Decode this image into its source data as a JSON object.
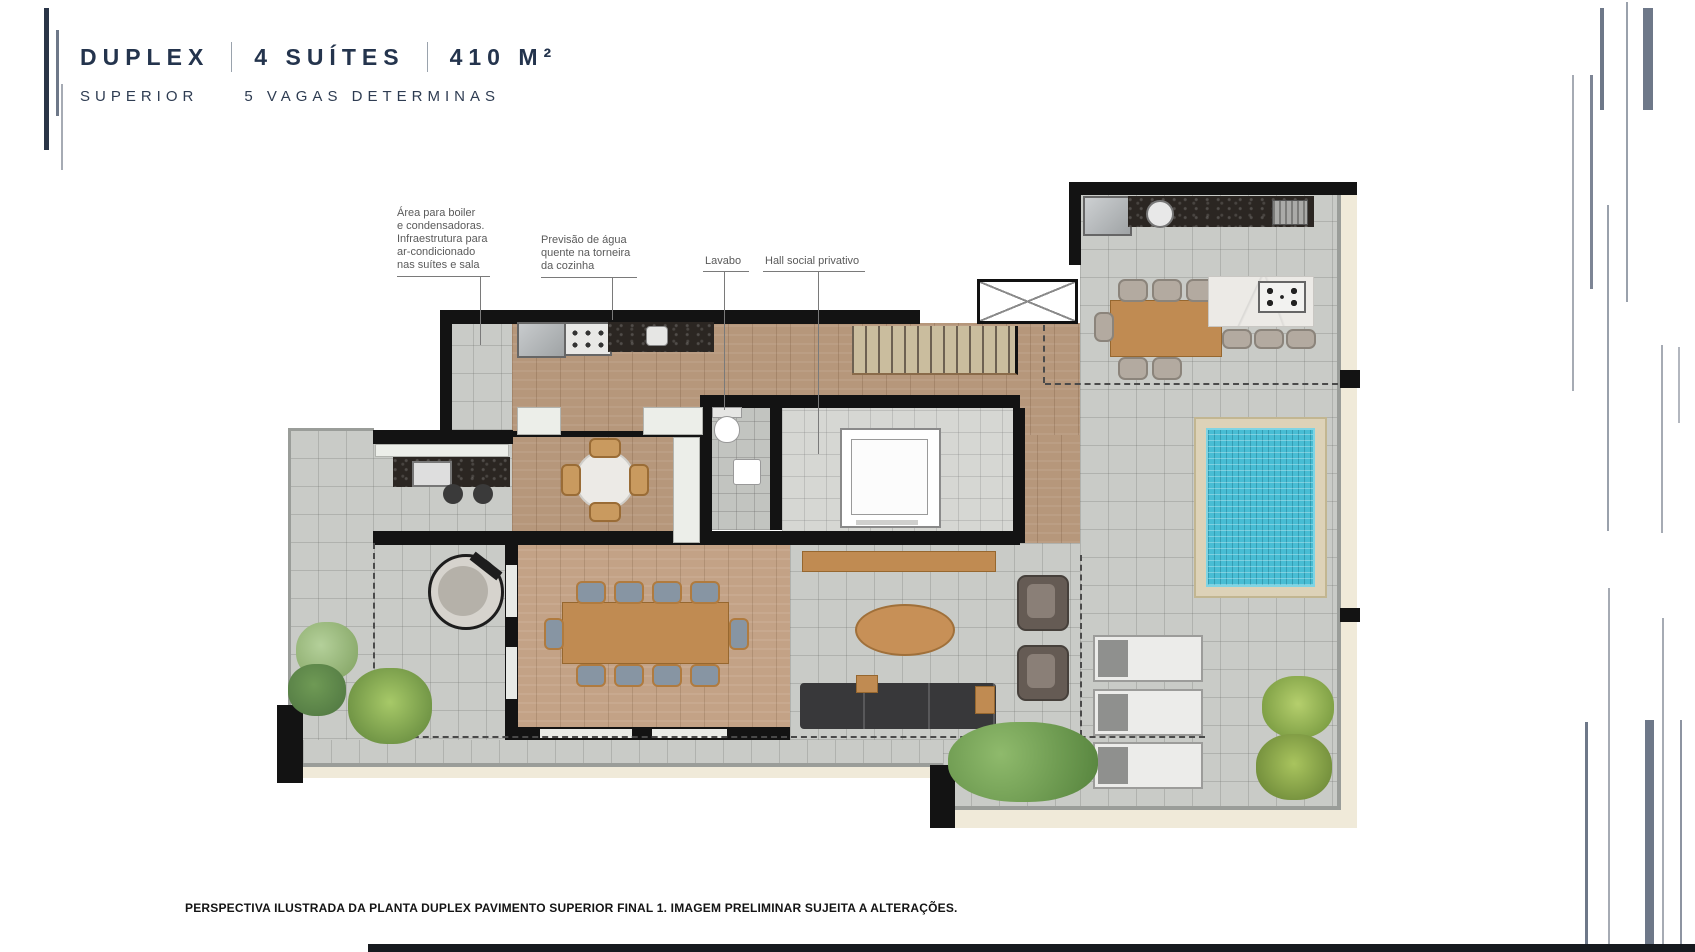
{
  "header": {
    "title_duplex": "DUPLEX",
    "title_suites": "4 SUÍTES",
    "title_area": "410 M²",
    "subtitle_left": "SUPERIOR",
    "subtitle_right": "5 VAGAS DETERMINAS"
  },
  "plan": {
    "annotations": {
      "boiler": "Área para boiler\ne condensadoras.\nInfraestrutura para\nar-condicionado\nnas suítes e sala",
      "water": "Previsão de água\nquente na torneira\nda cozinha",
      "lavabo": "Lavabo",
      "hall": "Hall social privativo"
    }
  },
  "footer": {
    "caption": "PERSPECTIVA ILUSTRADA DA PLANTA DUPLEX PAVIMENTO SUPERIOR FINAL 1. IMAGEM PRELIMINAR SUJEITA A ALTERAÇÕES."
  },
  "colors": {
    "accent_navy": "#24344d",
    "accent_slate": "#6e7889",
    "wall_black": "#131313",
    "concrete_floor": "#c9cbc7",
    "wood_floor": "#b6977b",
    "granite_counter": "#2b2622",
    "pool_water": "#48bdd4",
    "pool_deck": "#ddd2b8",
    "greenery": "#71a356"
  }
}
